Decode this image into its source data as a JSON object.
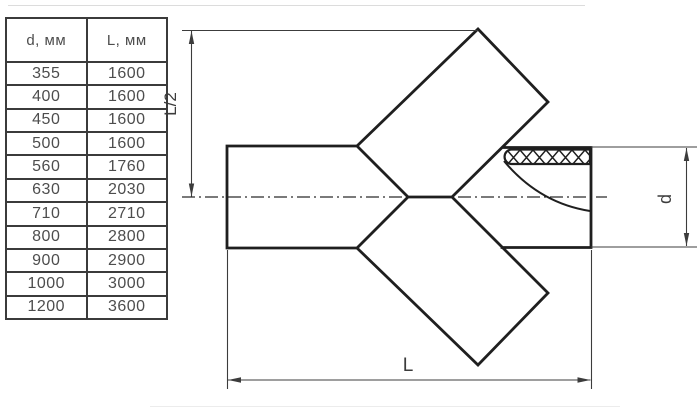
{
  "table": {
    "headers": [
      "d, мм",
      "L, мм"
    ],
    "rows": [
      {
        "d": "355",
        "l": "1600"
      },
      {
        "d": "400",
        "l": "1600"
      },
      {
        "d": "450",
        "l": "1600"
      },
      {
        "d": "500",
        "l": "1600"
      },
      {
        "d": "560",
        "l": "1760"
      },
      {
        "d": "630",
        "l": "2030"
      },
      {
        "d": "710",
        "l": "2710"
      },
      {
        "d": "800",
        "l": "2800"
      },
      {
        "d": "900",
        "l": "2900"
      },
      {
        "d": "1000",
        "l": "3000"
      },
      {
        "d": "1200",
        "l": "3600"
      }
    ]
  },
  "diagram": {
    "type": "45-degree cross pipe fitting, side view",
    "labels": {
      "half_length": "L/2",
      "length": "L",
      "diameter": "d"
    },
    "colors": {
      "outline": "#1f1f1f",
      "dimension": "#3c3c3c",
      "table_border": "#3b3b3b",
      "table_text": "#4d4d4d"
    }
  }
}
